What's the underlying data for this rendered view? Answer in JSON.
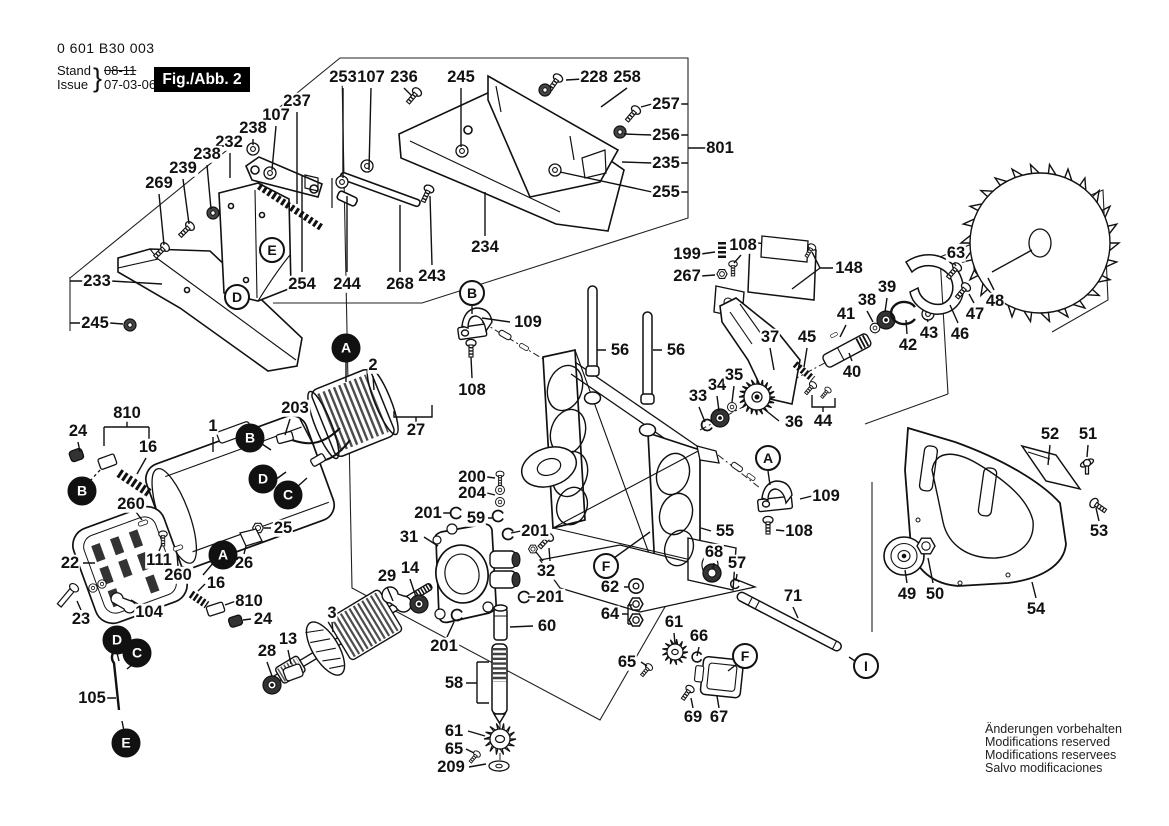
{
  "header": {
    "part_number": "0 601 B30 003",
    "stand_label": "Stand",
    "issue_label": "Issue",
    "brace": "}",
    "revision_old": "08-11",
    "revision_date": "07-03-06",
    "figure_label": "Fig./Abb. 2"
  },
  "footer": {
    "lines": [
      "Änderungen vorbehalten",
      "Modifications reserved",
      "Modifications reservees",
      "Salvo modificaciones"
    ]
  },
  "colors": {
    "ink": "#111111",
    "paper": "#ffffff"
  },
  "diagram": {
    "part_labels": [
      {
        "text": "253",
        "x": 343,
        "y": 77
      },
      {
        "text": "107",
        "x": 371,
        "y": 77
      },
      {
        "text": "236",
        "x": 404,
        "y": 77
      },
      {
        "text": "245",
        "x": 461,
        "y": 77
      },
      {
        "text": "228",
        "x": 594,
        "y": 77
      },
      {
        "text": "258",
        "x": 627,
        "y": 77
      },
      {
        "text": "257",
        "x": 666,
        "y": 104
      },
      {
        "text": "256",
        "x": 666,
        "y": 135
      },
      {
        "text": "235",
        "x": 666,
        "y": 163
      },
      {
        "text": "255",
        "x": 666,
        "y": 192
      },
      {
        "text": "801",
        "x": 720,
        "y": 148
      },
      {
        "text": "237",
        "x": 297,
        "y": 101
      },
      {
        "text": "107",
        "x": 276,
        "y": 115
      },
      {
        "text": "238",
        "x": 253,
        "y": 128
      },
      {
        "text": "232",
        "x": 229,
        "y": 142
      },
      {
        "text": "238",
        "x": 207,
        "y": 154
      },
      {
        "text": "239",
        "x": 183,
        "y": 168
      },
      {
        "text": "269",
        "x": 159,
        "y": 183
      },
      {
        "text": "233",
        "x": 97,
        "y": 281
      },
      {
        "text": "245",
        "x": 95,
        "y": 323
      },
      {
        "text": "254",
        "x": 302,
        "y": 284
      },
      {
        "text": "244",
        "x": 347,
        "y": 284
      },
      {
        "text": "268",
        "x": 400,
        "y": 284
      },
      {
        "text": "243",
        "x": 432,
        "y": 276
      },
      {
        "text": "234",
        "x": 485,
        "y": 247
      },
      {
        "text": "109",
        "x": 528,
        "y": 322
      },
      {
        "text": "108",
        "x": 472,
        "y": 390
      },
      {
        "text": "56",
        "x": 620,
        "y": 350
      },
      {
        "text": "56",
        "x": 676,
        "y": 350
      },
      {
        "text": "199",
        "x": 687,
        "y": 254
      },
      {
        "text": "108",
        "x": 743,
        "y": 245
      },
      {
        "text": "267",
        "x": 687,
        "y": 276
      },
      {
        "text": "148",
        "x": 849,
        "y": 268
      },
      {
        "text": "37",
        "x": 770,
        "y": 337
      },
      {
        "text": "45",
        "x": 807,
        "y": 337
      },
      {
        "text": "41",
        "x": 846,
        "y": 314
      },
      {
        "text": "38",
        "x": 867,
        "y": 300
      },
      {
        "text": "39",
        "x": 887,
        "y": 287
      },
      {
        "text": "63",
        "x": 956,
        "y": 253
      },
      {
        "text": "43",
        "x": 929,
        "y": 333
      },
      {
        "text": "42",
        "x": 908,
        "y": 345
      },
      {
        "text": "46",
        "x": 960,
        "y": 334
      },
      {
        "text": "47",
        "x": 975,
        "y": 314
      },
      {
        "text": "48",
        "x": 995,
        "y": 301
      },
      {
        "text": "40",
        "x": 852,
        "y": 372
      },
      {
        "text": "44",
        "x": 823,
        "y": 421
      },
      {
        "text": "36",
        "x": 794,
        "y": 422
      },
      {
        "text": "33",
        "x": 698,
        "y": 396
      },
      {
        "text": "34",
        "x": 717,
        "y": 385
      },
      {
        "text": "35",
        "x": 734,
        "y": 375
      },
      {
        "text": "2",
        "x": 373,
        "y": 365
      },
      {
        "text": "27",
        "x": 416,
        "y": 430
      },
      {
        "text": "810",
        "x": 127,
        "y": 413
      },
      {
        "text": "24",
        "x": 78,
        "y": 431
      },
      {
        "text": "16",
        "x": 148,
        "y": 447
      },
      {
        "text": "1",
        "x": 213,
        "y": 426
      },
      {
        "text": "203",
        "x": 295,
        "y": 408
      },
      {
        "text": "260",
        "x": 131,
        "y": 504
      },
      {
        "text": "25",
        "x": 283,
        "y": 528
      },
      {
        "text": "22",
        "x": 70,
        "y": 563
      },
      {
        "text": "111",
        "x": 159,
        "y": 560
      },
      {
        "text": "260",
        "x": 178,
        "y": 575
      },
      {
        "text": "26",
        "x": 244,
        "y": 563
      },
      {
        "text": "16",
        "x": 216,
        "y": 583
      },
      {
        "text": "810",
        "x": 249,
        "y": 601
      },
      {
        "text": "24",
        "x": 263,
        "y": 619
      },
      {
        "text": "23",
        "x": 81,
        "y": 619
      },
      {
        "text": "104",
        "x": 149,
        "y": 612
      },
      {
        "text": "3",
        "x": 332,
        "y": 613
      },
      {
        "text": "28",
        "x": 267,
        "y": 651
      },
      {
        "text": "13",
        "x": 288,
        "y": 639
      },
      {
        "text": "105",
        "x": 92,
        "y": 698
      },
      {
        "text": "200",
        "x": 472,
        "y": 477
      },
      {
        "text": "204",
        "x": 472,
        "y": 493
      },
      {
        "text": "201",
        "x": 428,
        "y": 513
      },
      {
        "text": "59",
        "x": 476,
        "y": 518
      },
      {
        "text": "31",
        "x": 409,
        "y": 537
      },
      {
        "text": "29",
        "x": 387,
        "y": 576
      },
      {
        "text": "14",
        "x": 410,
        "y": 568
      },
      {
        "text": "201",
        "x": 535,
        "y": 531
      },
      {
        "text": "32",
        "x": 546,
        "y": 571
      },
      {
        "text": "201",
        "x": 550,
        "y": 597
      },
      {
        "text": "60",
        "x": 547,
        "y": 626
      },
      {
        "text": "201",
        "x": 444,
        "y": 646
      },
      {
        "text": "58",
        "x": 454,
        "y": 683
      },
      {
        "text": "61",
        "x": 454,
        "y": 731
      },
      {
        "text": "65",
        "x": 454,
        "y": 749
      },
      {
        "text": "209",
        "x": 451,
        "y": 767
      },
      {
        "text": "62",
        "x": 610,
        "y": 587
      },
      {
        "text": "64",
        "x": 610,
        "y": 614
      },
      {
        "text": "65",
        "x": 627,
        "y": 662
      },
      {
        "text": "61",
        "x": 674,
        "y": 622
      },
      {
        "text": "66",
        "x": 699,
        "y": 636
      },
      {
        "text": "69",
        "x": 693,
        "y": 717
      },
      {
        "text": "67",
        "x": 719,
        "y": 717
      },
      {
        "text": "55",
        "x": 725,
        "y": 531
      },
      {
        "text": "108",
        "x": 799,
        "y": 531
      },
      {
        "text": "68",
        "x": 714,
        "y": 552
      },
      {
        "text": "57",
        "x": 737,
        "y": 563
      },
      {
        "text": "71",
        "x": 793,
        "y": 596
      },
      {
        "text": "109",
        "x": 826,
        "y": 496
      },
      {
        "text": "52",
        "x": 1050,
        "y": 434
      },
      {
        "text": "51",
        "x": 1088,
        "y": 434
      },
      {
        "text": "53",
        "x": 1099,
        "y": 531
      },
      {
        "text": "49",
        "x": 907,
        "y": 594
      },
      {
        "text": "50",
        "x": 935,
        "y": 594
      },
      {
        "text": "54",
        "x": 1036,
        "y": 609
      }
    ],
    "markers": [
      {
        "letter": "E",
        "x": 272,
        "y": 250,
        "filled": false
      },
      {
        "letter": "D",
        "x": 237,
        "y": 297,
        "filled": false
      },
      {
        "letter": "B",
        "x": 472,
        "y": 293,
        "filled": false
      },
      {
        "letter": "A",
        "x": 768,
        "y": 458,
        "filled": false
      },
      {
        "letter": "F",
        "x": 606,
        "y": 566,
        "filled": false
      },
      {
        "letter": "F",
        "x": 745,
        "y": 656,
        "filled": false
      },
      {
        "letter": "I",
        "x": 866,
        "y": 666,
        "filled": false
      },
      {
        "letter": "A",
        "x": 346,
        "y": 348,
        "filled": true
      },
      {
        "letter": "B",
        "x": 250,
        "y": 438,
        "filled": true
      },
      {
        "letter": "D",
        "x": 263,
        "y": 479,
        "filled": true
      },
      {
        "letter": "C",
        "x": 288,
        "y": 495,
        "filled": true
      },
      {
        "letter": "B",
        "x": 82,
        "y": 491,
        "filled": true
      },
      {
        "letter": "A",
        "x": 223,
        "y": 555,
        "filled": true
      },
      {
        "letter": "D",
        "x": 117,
        "y": 640,
        "filled": true
      },
      {
        "letter": "C",
        "x": 137,
        "y": 653,
        "filled": true
      },
      {
        "letter": "E",
        "x": 126,
        "y": 743,
        "filled": true
      }
    ]
  }
}
